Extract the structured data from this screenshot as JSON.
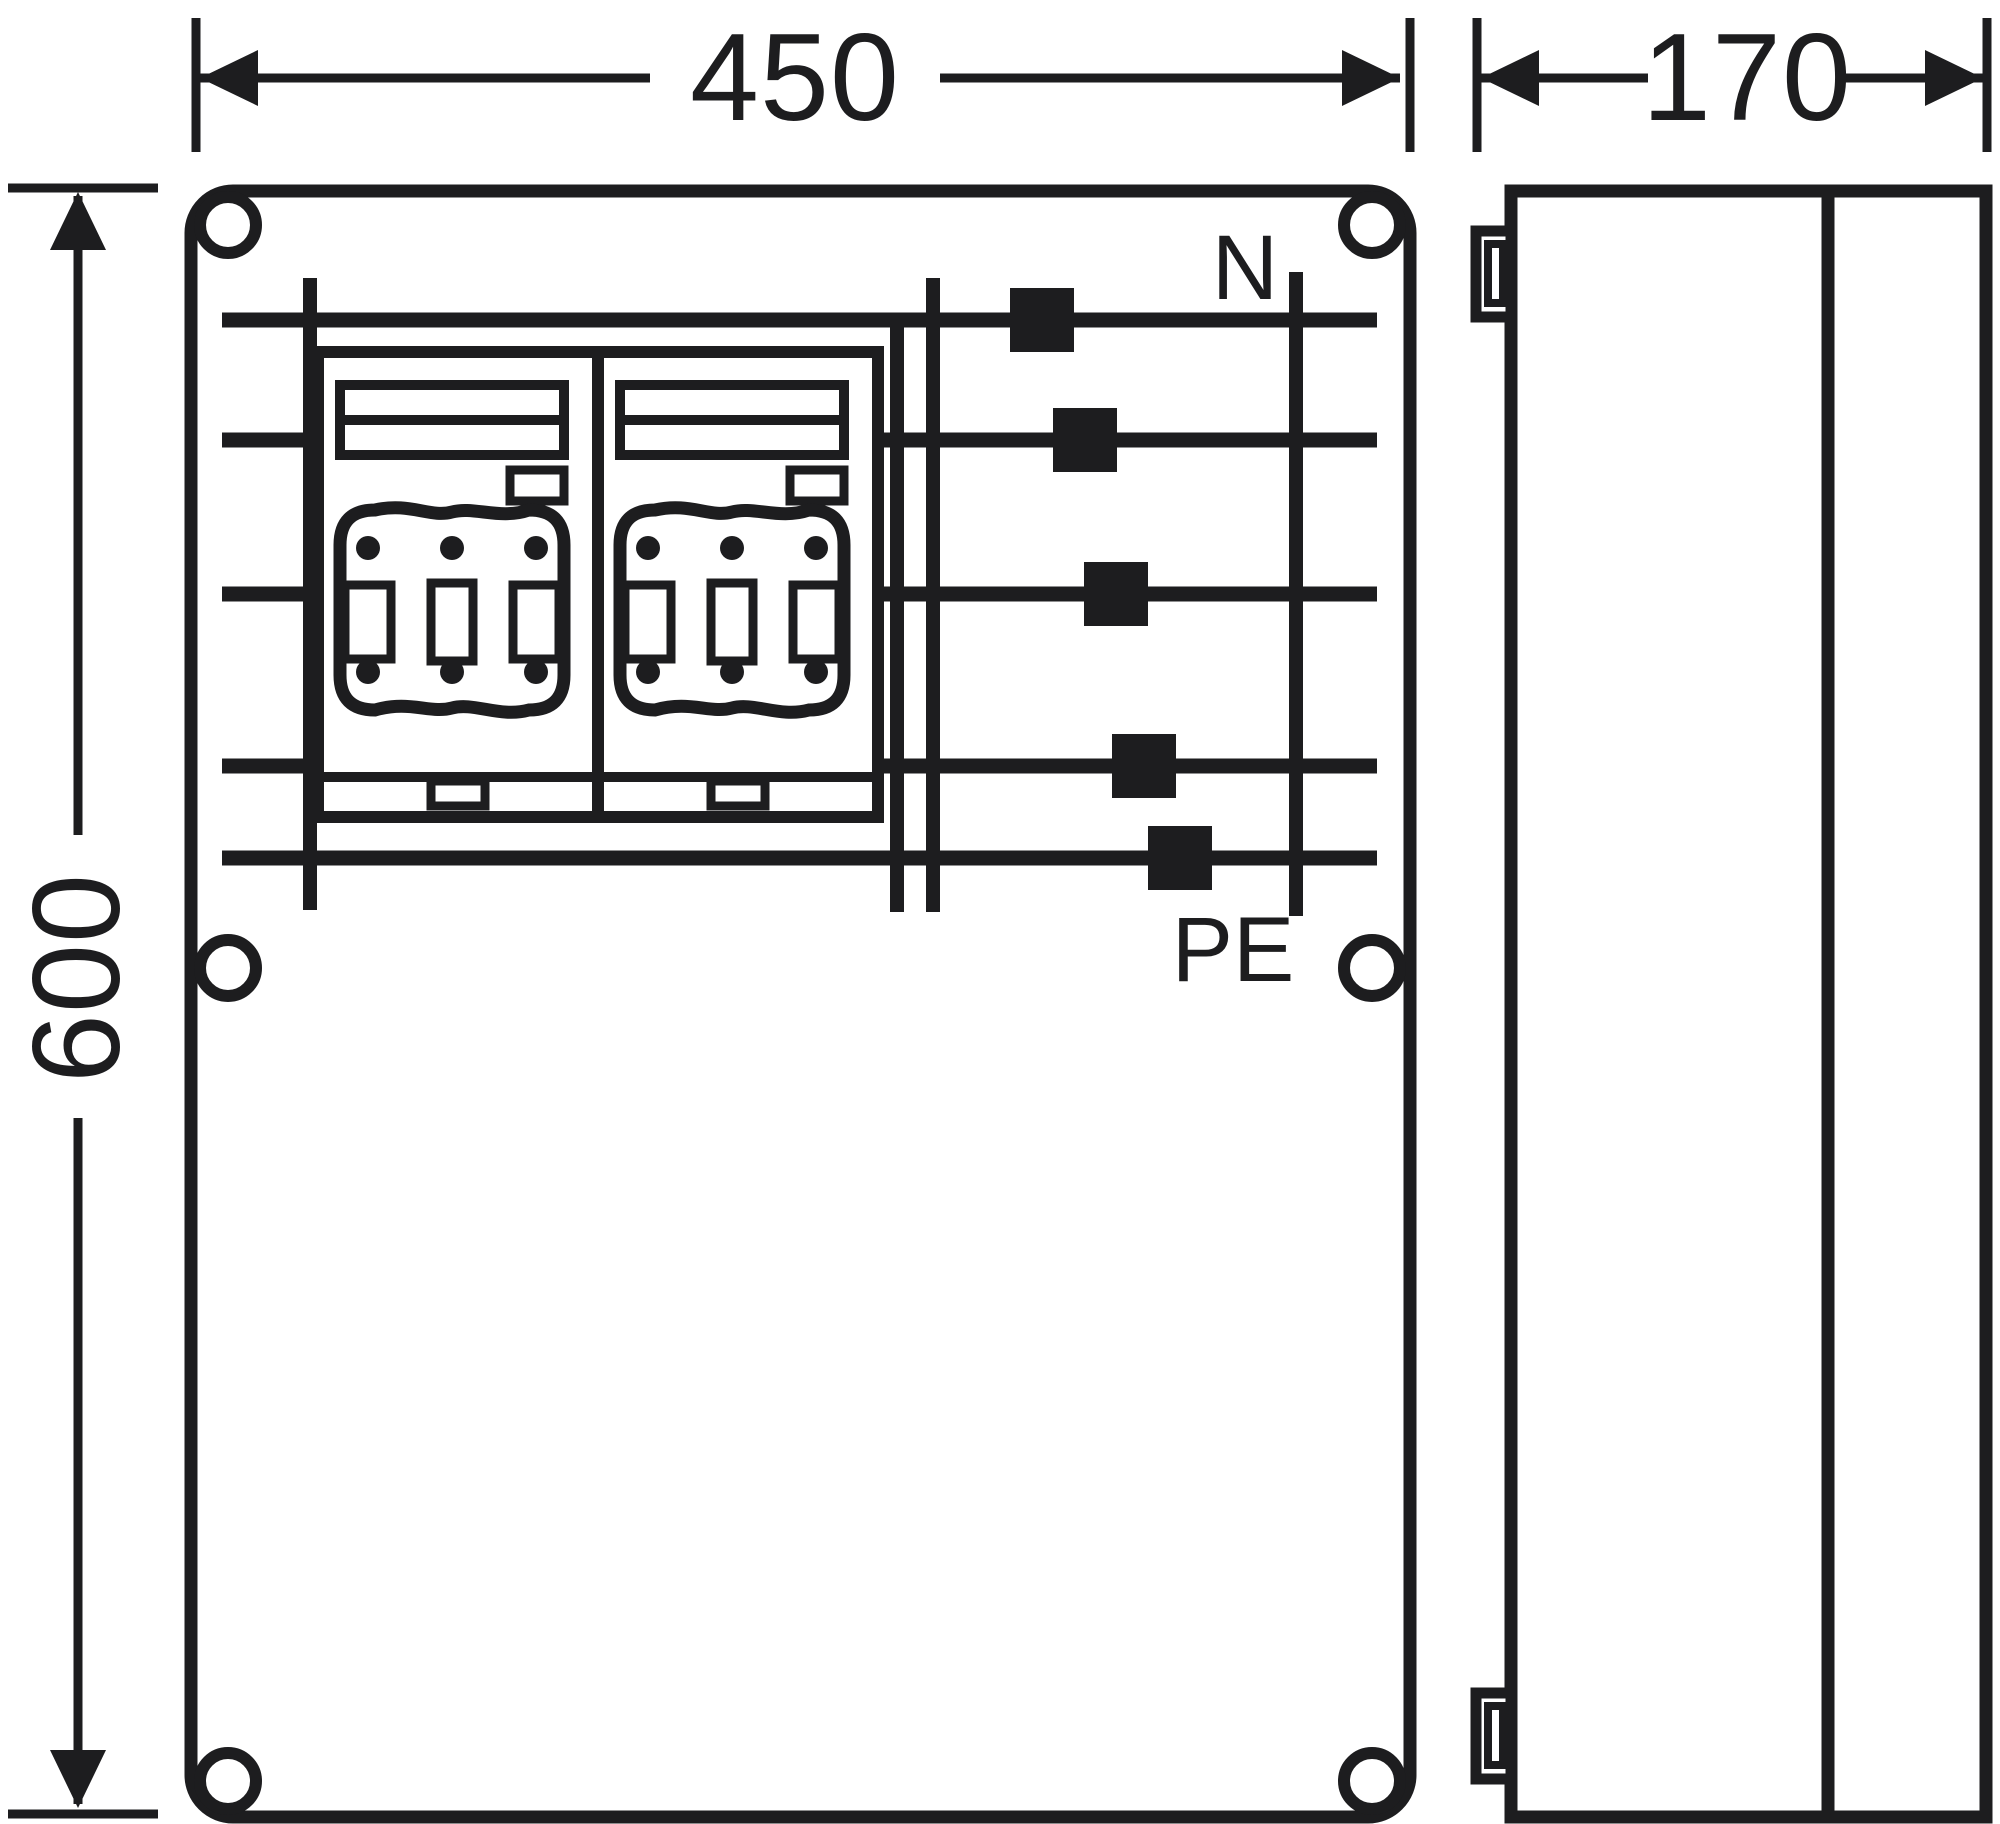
{
  "colors": {
    "ink": "#1d1d1f",
    "background": "#ffffff"
  },
  "dimensions": {
    "width": "450",
    "depth": "170",
    "height": "600"
  },
  "busbars": {
    "neutral_label": "N",
    "pe_label": "PE"
  }
}
